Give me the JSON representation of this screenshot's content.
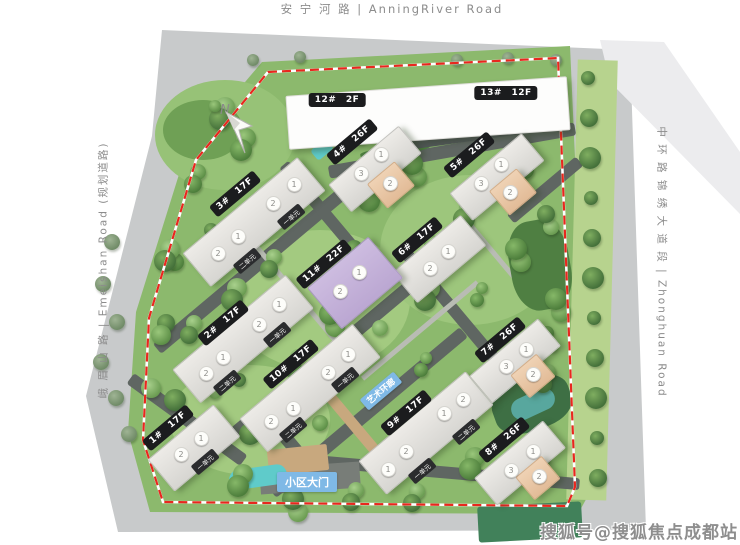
{
  "roads": {
    "top": "安 宁 河 路  |  AnningRiver Road",
    "left": "峨 眉 山 路  |  Emeishan Road (规划道路)",
    "right": "中 环 路 锦 绣 大 道 段  |  Zhonghuan Road"
  },
  "watermark": "搜狐号@搜狐焦点成都站",
  "compass_label": "N",
  "colors": {
    "boundary_red": "#e8281e",
    "site_green": "#8cb96d",
    "road_gray": "#c8cacb",
    "label_black": "#1b1c1e",
    "label_blue": "#7fb9e6",
    "building_gray": "#dcdbd7",
    "building_peach": "#e8c9a8",
    "building_purple": "#c3b0d8",
    "pool_teal": "#5fcbca"
  },
  "site_labels": [
    {
      "text": "小区大门",
      "x": 307,
      "y": 482,
      "rot": 0,
      "size": 11
    },
    {
      "text": "艺术环廊",
      "x": 381,
      "y": 391,
      "rot": -40,
      "size": 8.5
    }
  ],
  "top_building": {
    "labels": [
      {
        "text": "12# 2F",
        "x": 337,
        "y": 100
      },
      {
        "text": "13# 12F",
        "x": 506,
        "y": 93
      }
    ]
  },
  "buildings": [
    {
      "label": "3# 17F",
      "lx": 235,
      "ly": 194,
      "cx": 253,
      "cy": 221,
      "len": 148,
      "wid": 42,
      "rot": -40,
      "color": "gray",
      "circles": [
        {
          "x": 293,
          "y": 183,
          "n": "1"
        },
        {
          "x": 272,
          "y": 202,
          "n": "2"
        },
        {
          "x": 237,
          "y": 235,
          "n": "1"
        },
        {
          "x": 217,
          "y": 252,
          "n": "2"
        }
      ],
      "units": [
        {
          "x": 291,
          "y": 217,
          "t": "一单元"
        },
        {
          "x": 247,
          "y": 261,
          "t": "二单元"
        }
      ]
    },
    {
      "label": "4# 26F",
      "lx": 352,
      "ly": 142,
      "cx": 374,
      "cy": 168,
      "len": 90,
      "wid": 34,
      "rot": -40,
      "color": "gray",
      "peach": {
        "cx": 390,
        "cy": 184,
        "w": 34,
        "h": 30
      },
      "circles": [
        {
          "x": 380,
          "y": 153,
          "n": "1"
        },
        {
          "x": 360,
          "y": 172,
          "n": "3"
        },
        {
          "x": 389,
          "y": 182,
          "n": "2"
        }
      ],
      "units": []
    },
    {
      "label": "5# 26F",
      "lx": 469,
      "ly": 155,
      "cx": 496,
      "cy": 176,
      "len": 92,
      "wid": 34,
      "rot": -40,
      "color": "gray",
      "peach": {
        "cx": 512,
        "cy": 191,
        "w": 34,
        "h": 30
      },
      "circles": [
        {
          "x": 500,
          "y": 163,
          "n": "1"
        },
        {
          "x": 480,
          "y": 182,
          "n": "3"
        },
        {
          "x": 509,
          "y": 191,
          "n": "2"
        }
      ],
      "units": []
    },
    {
      "label": "6# 17F",
      "lx": 417,
      "ly": 240,
      "cx": 438,
      "cy": 258,
      "len": 88,
      "wid": 38,
      "rot": -40,
      "color": "gray",
      "circles": [
        {
          "x": 447,
          "y": 250,
          "n": "1"
        },
        {
          "x": 429,
          "y": 267,
          "n": "2"
        }
      ],
      "units": []
    },
    {
      "label": "11# 22F",
      "lx": 324,
      "ly": 264,
      "cx": 354,
      "cy": 282,
      "len": 78,
      "wid": 52,
      "rot": -40,
      "color": "purple",
      "circles": [
        {
          "x": 358,
          "y": 271,
          "n": "1"
        },
        {
          "x": 339,
          "y": 290,
          "n": "2"
        }
      ],
      "units": []
    },
    {
      "label": "2# 17F",
      "lx": 223,
      "ly": 323,
      "cx": 242,
      "cy": 338,
      "len": 146,
      "wid": 42,
      "rot": -40,
      "color": "gray",
      "circles": [
        {
          "x": 278,
          "y": 303,
          "n": "1"
        },
        {
          "x": 258,
          "y": 323,
          "n": "2"
        },
        {
          "x": 222,
          "y": 356,
          "n": "1"
        },
        {
          "x": 205,
          "y": 372,
          "n": "2"
        }
      ],
      "units": [
        {
          "x": 277,
          "y": 335,
          "t": "一单元"
        },
        {
          "x": 227,
          "y": 383,
          "t": "二单元"
        }
      ]
    },
    {
      "label": "10# 17F",
      "lx": 291,
      "ly": 364,
      "cx": 309,
      "cy": 387,
      "len": 146,
      "wid": 42,
      "rot": -40,
      "color": "gray",
      "circles": [
        {
          "x": 347,
          "y": 353,
          "n": "1"
        },
        {
          "x": 327,
          "y": 371,
          "n": "2"
        },
        {
          "x": 292,
          "y": 407,
          "n": "1"
        },
        {
          "x": 270,
          "y": 420,
          "n": "2"
        }
      ],
      "units": [
        {
          "x": 345,
          "y": 380,
          "t": "一单元"
        },
        {
          "x": 293,
          "y": 430,
          "t": "二单元"
        }
      ]
    },
    {
      "label": "1# 17F",
      "lx": 168,
      "ly": 428,
      "cx": 193,
      "cy": 447,
      "len": 84,
      "wid": 40,
      "rot": -40,
      "color": "gray",
      "circles": [
        {
          "x": 200,
          "y": 437,
          "n": "1"
        },
        {
          "x": 180,
          "y": 453,
          "n": "2"
        }
      ],
      "units": [
        {
          "x": 205,
          "y": 462,
          "t": "一单元"
        }
      ]
    },
    {
      "label": "9# 17F",
      "lx": 406,
      "ly": 413,
      "cx": 425,
      "cy": 432,
      "len": 138,
      "wid": 42,
      "rot": -40,
      "color": "gray",
      "circles": [
        {
          "x": 462,
          "y": 398,
          "n": "2"
        },
        {
          "x": 443,
          "y": 412,
          "n": "1"
        },
        {
          "x": 405,
          "y": 450,
          "n": "2"
        },
        {
          "x": 387,
          "y": 468,
          "n": "1"
        }
      ],
      "units": [
        {
          "x": 466,
          "y": 432,
          "t": "二单元"
        },
        {
          "x": 422,
          "y": 471,
          "t": "一单元"
        }
      ]
    },
    {
      "label": "7# 26F",
      "lx": 500,
      "ly": 340,
      "cx": 514,
      "cy": 360,
      "len": 88,
      "wid": 34,
      "rot": -40,
      "color": "gray",
      "peach": {
        "cx": 532,
        "cy": 375,
        "w": 32,
        "h": 28
      },
      "circles": [
        {
          "x": 525,
          "y": 348,
          "n": "1"
        },
        {
          "x": 505,
          "y": 365,
          "n": "3"
        },
        {
          "x": 532,
          "y": 373,
          "n": "2"
        }
      ],
      "units": []
    },
    {
      "label": "8# 26F",
      "lx": 504,
      "ly": 440,
      "cx": 519,
      "cy": 462,
      "len": 88,
      "wid": 34,
      "rot": -40,
      "color": "gray",
      "peach": {
        "cx": 537,
        "cy": 477,
        "w": 32,
        "h": 28
      },
      "circles": [
        {
          "x": 532,
          "y": 450,
          "n": "1"
        },
        {
          "x": 510,
          "y": 469,
          "n": "3"
        },
        {
          "x": 538,
          "y": 475,
          "n": "2"
        }
      ],
      "units": []
    }
  ]
}
